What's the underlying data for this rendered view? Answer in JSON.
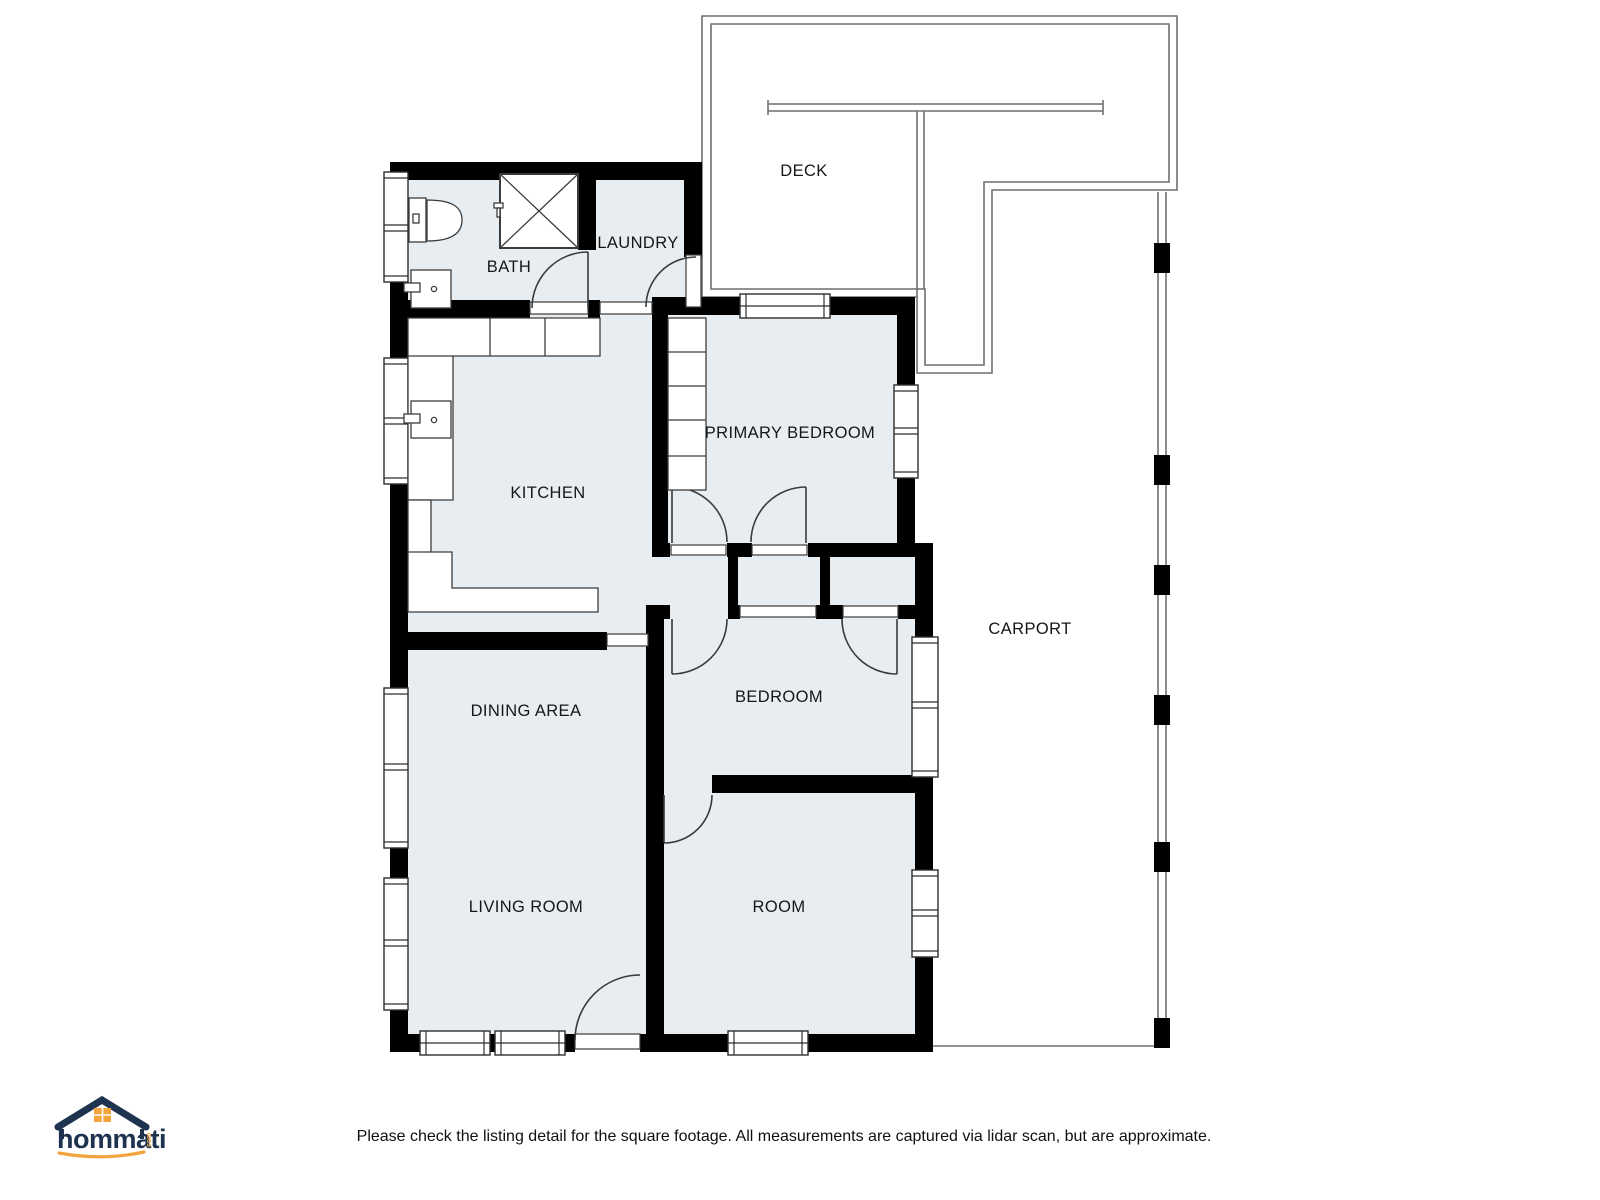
{
  "rooms": [
    {
      "id": "deck",
      "label": "DECK"
    },
    {
      "id": "bath",
      "label": "BATH"
    },
    {
      "id": "laundry",
      "label": "LAUNDRY"
    },
    {
      "id": "kitchen",
      "label": "KITCHEN"
    },
    {
      "id": "primary-bedroom",
      "label": "PRIMARY BEDROOM"
    },
    {
      "id": "dining-area",
      "label": "DINING AREA"
    },
    {
      "id": "bedroom",
      "label": "BEDROOM"
    },
    {
      "id": "carport",
      "label": "CARPORT"
    },
    {
      "id": "living-room",
      "label": "LIVING ROOM"
    },
    {
      "id": "room",
      "label": "ROOM"
    }
  ],
  "branding": {
    "logo_text": "hommati",
    "logo_suffix": "com"
  },
  "footer": {
    "disclaimer": "Please check the listing detail for the square footage. All measurements are captured via lidar scan, but are approximate."
  },
  "colors": {
    "floor": "#e8edf2",
    "wall": "#000000",
    "fixture_line": "#3c3c3c",
    "deck_line": "#6f6f6f",
    "logo_navy": "#1e3350",
    "logo_orange": "#f2a33c"
  }
}
